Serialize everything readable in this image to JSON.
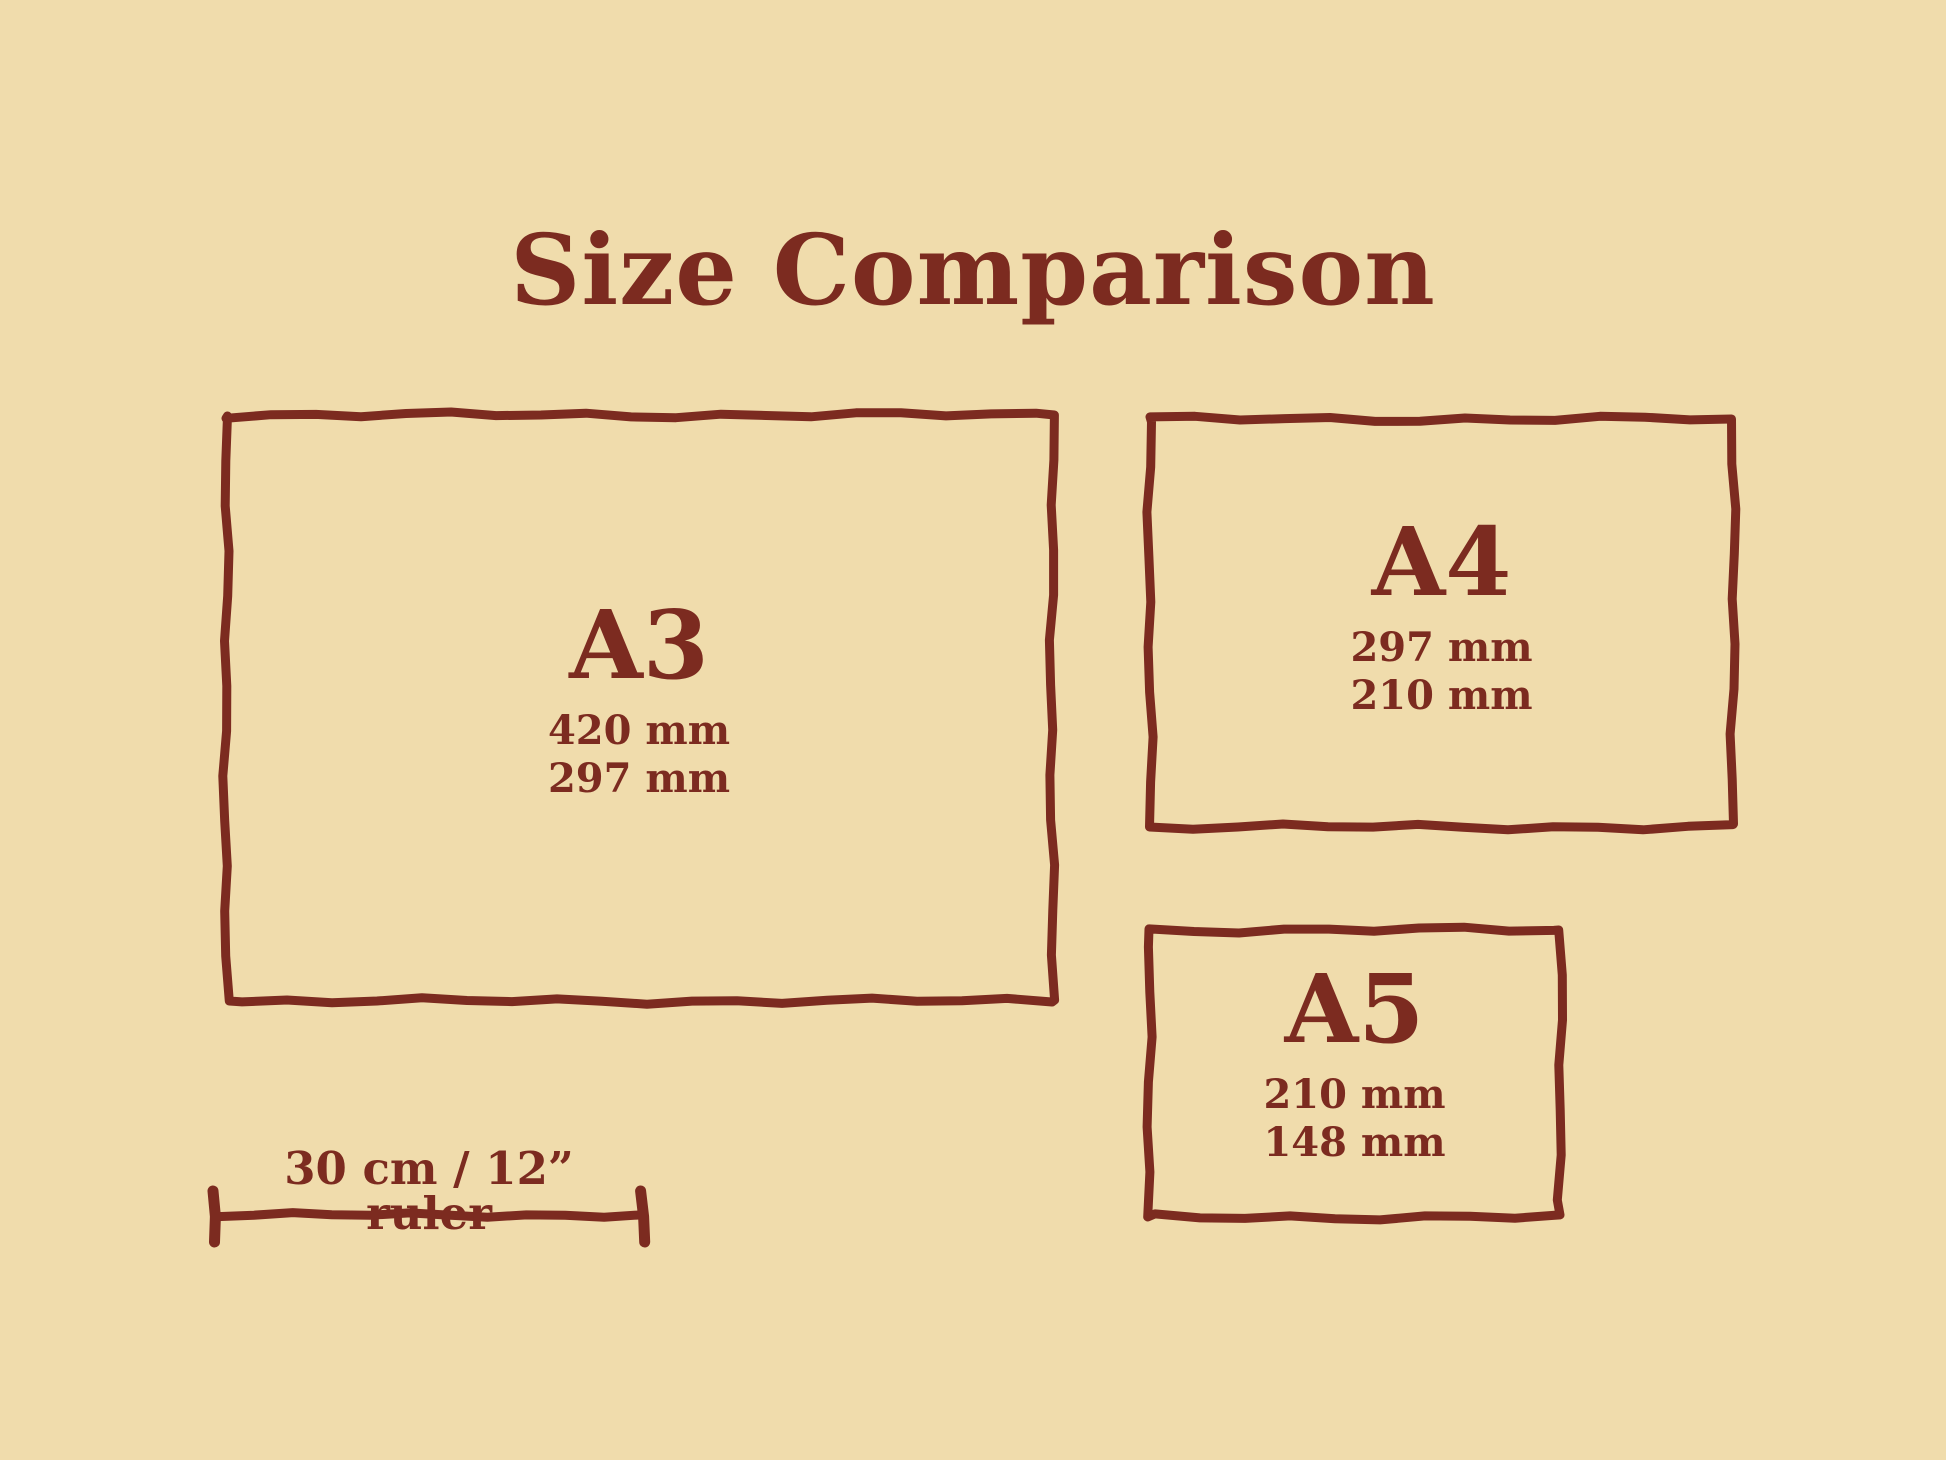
{
  "title": "Size Comparison",
  "colors": {
    "background": "#F0DCAC",
    "ink": "#7C2B20"
  },
  "papers": [
    {
      "name": "A3",
      "width_label": "420 mm",
      "height_label": "297 mm"
    },
    {
      "name": "A4",
      "width_label": "297 mm",
      "height_label": "210 mm"
    },
    {
      "name": "A5",
      "width_label": "210 mm",
      "height_label": "148 mm"
    }
  ],
  "ruler": {
    "label": "30 cm / 12” ruler"
  }
}
